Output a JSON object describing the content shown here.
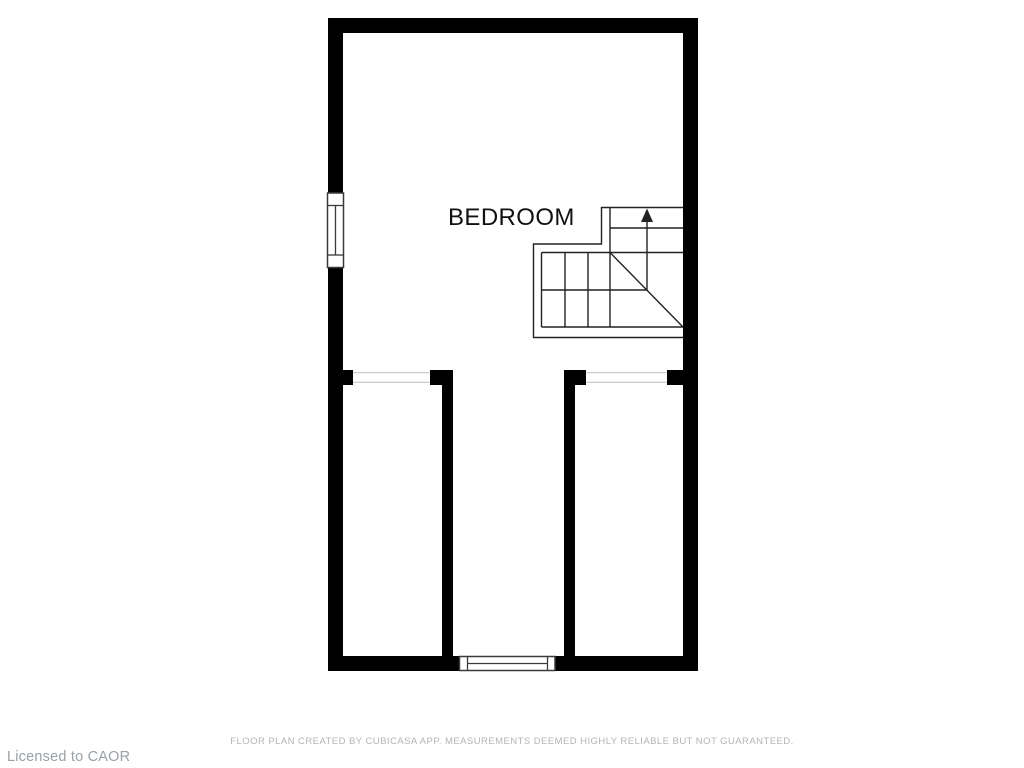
{
  "canvas": {
    "width": 1024,
    "height": 768,
    "background": "#ffffff"
  },
  "floor_plan": {
    "rooms": [
      {
        "label": "BEDROOM"
      }
    ],
    "staircase": {
      "direction": "up"
    },
    "colors": {
      "wall": "#000000",
      "stair_line": "#222222",
      "window_frame": "#3a3a3a",
      "opening_line": "#cccccc",
      "room_label": "#111111"
    }
  },
  "footer": {
    "disclaimer": "FLOOR PLAN CREATED BY CUBICASA APP. MEASUREMENTS DEEMED HIGHLY RELIABLE BUT NOT GUARANTEED.",
    "license": "Licensed to CAOR",
    "colors": {
      "disclaimer": "#b4b4b4",
      "license": "#9aa0a5"
    }
  }
}
